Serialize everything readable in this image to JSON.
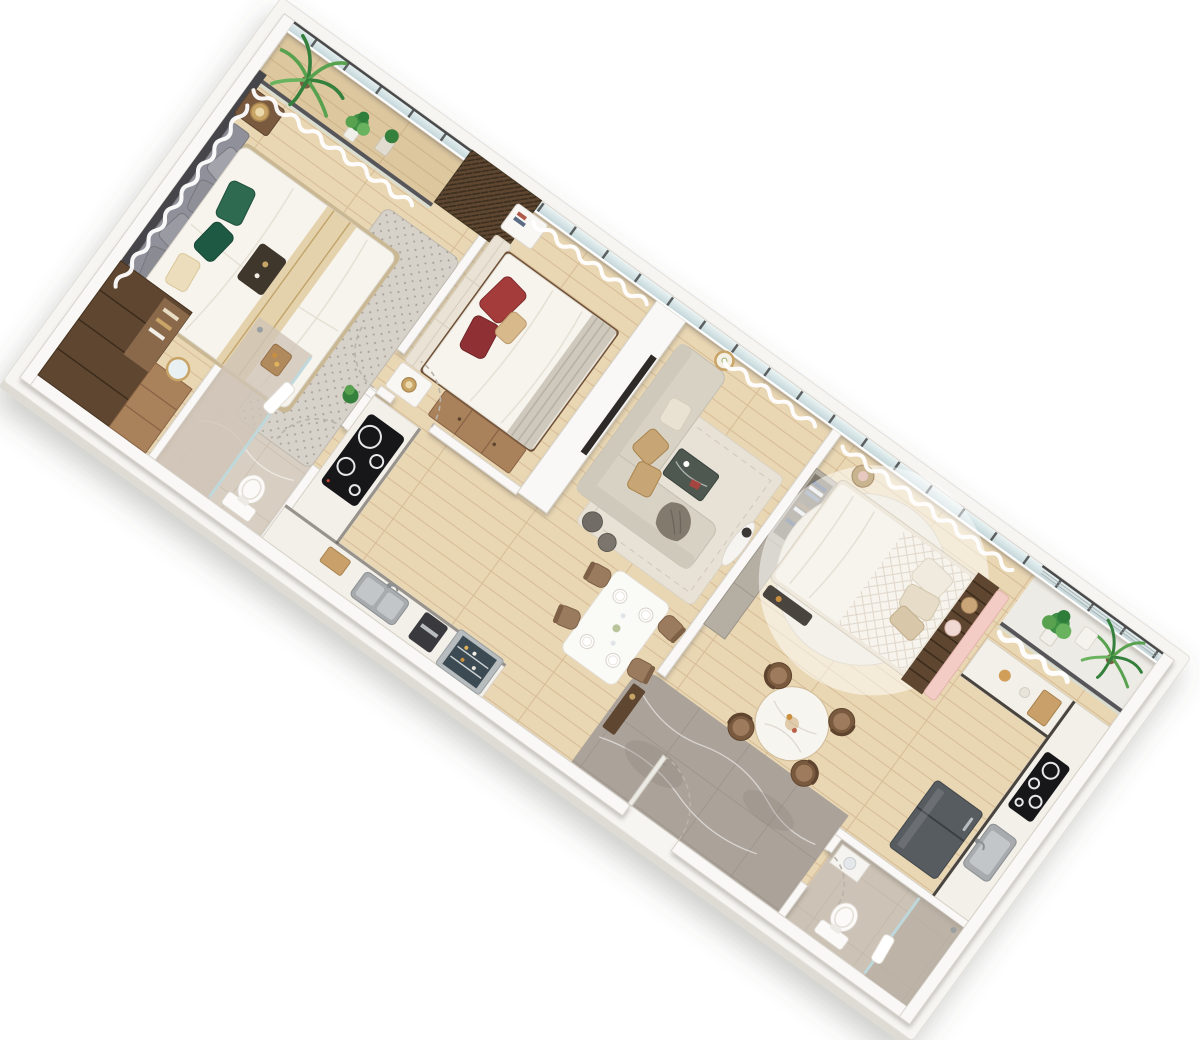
{
  "scene": {
    "type": "apartment-3d-floor-plan-render",
    "view": "rotated-dollhouse-top-view",
    "rotation_deg": 36,
    "rooms": [
      {
        "id": "bedroom-1",
        "furniture": [
          "double-bed",
          "upholstered-headboard",
          "gray-scatter-pillows",
          "green-accent-pillows",
          "nightstands-with-lamps",
          "dark-wood-wardrobe",
          "vanity-with-mirror",
          "speckled-area-rug",
          "window-curtains"
        ]
      },
      {
        "id": "balcony-1",
        "furniture": [
          "glass-railing",
          "potted-palm",
          "potted-plants",
          "louvered-ac-screen"
        ]
      },
      {
        "id": "bathroom-1",
        "furniture": [
          "walk-in-shower",
          "glass-screen",
          "towel",
          "toilet",
          "wooden-caddy",
          "plant"
        ]
      },
      {
        "id": "kitchen",
        "furniture": [
          "l-shaped-counter",
          "induction-cooktop",
          "double-sink",
          "cutting-board",
          "coffee-machine",
          "glass-door-cooler"
        ]
      },
      {
        "id": "bedroom-2",
        "furniture": [
          "double-bed",
          "cream-tufted-headboard",
          "maroon-pillows",
          "striped-foot-runner",
          "white-nightstands",
          "books",
          "table-lamp",
          "low-wardrobe"
        ]
      },
      {
        "id": "living-room",
        "furniture": [
          "l-shaped-sofa",
          "tan-cushions",
          "draped-throw",
          "area-rug",
          "dark-stone-coffee-table",
          "round-gold-side-table",
          "poufs",
          "tv-niche-wall",
          "oval-console"
        ]
      },
      {
        "id": "dining-area",
        "furniture": [
          "rectangular-dining-table",
          "four-upholstered-chairs",
          "place-settings"
        ]
      },
      {
        "id": "entry-corridor",
        "furniture": [
          "gray-marble-floor",
          "entry-door",
          "console-bench"
        ]
      },
      {
        "id": "bedroom-3",
        "furniture": [
          "double-bed",
          "slatted-walnut-headboard",
          "pink-upholstered-frame",
          "bolster-pillows",
          "quilted-duvet",
          "round-white-rug",
          "round-nightstand",
          "foot-bench",
          "open-wardrobe-shelves"
        ]
      },
      {
        "id": "dining-area-2",
        "furniture": [
          "round-marble-table",
          "four-round-chairs"
        ]
      },
      {
        "id": "kitchenette",
        "furniture": [
          "l-shaped-counter",
          "induction-cooktop",
          "sink",
          "refrigerator",
          "cutting-board"
        ]
      },
      {
        "id": "bathroom-2",
        "furniture": [
          "toilet",
          "glass-shower",
          "vanity-basin",
          "towel"
        ]
      },
      {
        "id": "balcony-2",
        "furniture": [
          "railing",
          "potted-palm",
          "potted-fern",
          "white-planter"
        ]
      }
    ]
  },
  "palette": {
    "slab_top": "#f6f5f2",
    "slab_side": "#dedbd5",
    "wall": "#f9f8f6",
    "wall_edge": "#d7d3cc",
    "floor_wood": "#e9d6b2",
    "floor_balcony": "#ddc79e",
    "tile_light": "#edebe5",
    "marble_beige": "#d8cec1",
    "marble_beige2": "#ccc2b5",
    "marble_gray": "#aba39a",
    "curtain": "#ffffff",
    "walnut_dark": "#5e4631",
    "walnut": "#7a5a3f",
    "wood_tan": "#a9825c",
    "sofa": "#d8d2c5",
    "cushion": "#c8a574",
    "throw": "#837a6e",
    "rug": "#e8e2d6",
    "rug_speckle": "#d6d1c9",
    "rug_round": "#f4f1ea",
    "bed_white": "#f7f4ee",
    "headboard_gray": "#90909a",
    "headboard_cream": "#eae3d5",
    "pillow_green": "#2d6a50",
    "pillow_maroon": "#a43c3c",
    "pillow_tan": "#d7b98c",
    "pink": "#f3ccc5",
    "stone": "#4e5850",
    "counter": "#f3f0ea",
    "cooktop": "#17171a",
    "steel": "#a7abad",
    "fridge": "#575c61",
    "gold": "#c9a467",
    "plant": "#58a24f",
    "plant_dark": "#35803c",
    "door_leaf": "#eceae4"
  }
}
